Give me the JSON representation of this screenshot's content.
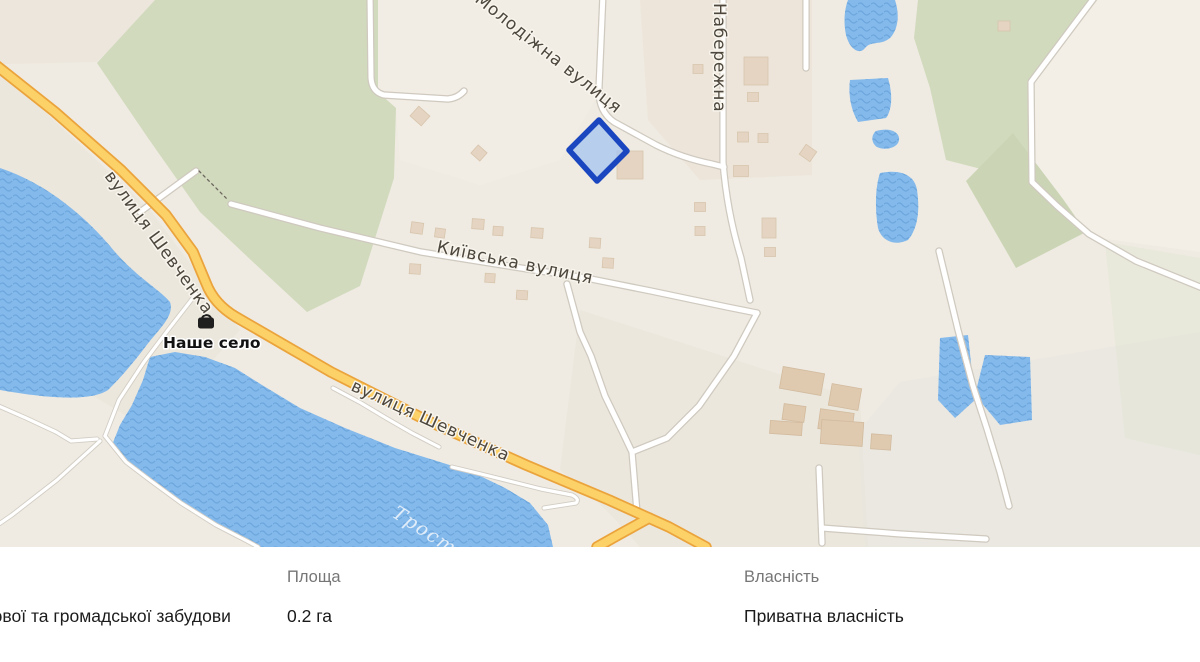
{
  "map": {
    "streets": [
      {
        "id": "molodizhna",
        "text": "Молодіжна вулиця"
      },
      {
        "id": "naberezhna",
        "text": "Набережна"
      },
      {
        "id": "kyivska",
        "text": "Київська вулиця"
      },
      {
        "id": "shevchenka_upper",
        "text": "вулиця Шевченка"
      },
      {
        "id": "shevchenka_lower",
        "text": "вулиця Шевченка"
      }
    ],
    "poi": {
      "label": "Наше село",
      "icon": "shop-basket-icon"
    },
    "river_label": "Трост",
    "parcel": {
      "fill": "#a6c5ef",
      "border": "#1a46c0"
    },
    "palette": {
      "land": "#efebe2",
      "forest": "#d1dabd",
      "water": "#84b9ec",
      "water_wave": "#69a4da",
      "road_primary_fill": "#fbd168",
      "road_primary_casing": "#eba33c",
      "road_fill": "#ffffff",
      "road_casing": "#cfc9bf",
      "building": "#e4d4c1"
    }
  },
  "info_panel": {
    "land_use_fragment": "нової та громадської забудови",
    "fields": [
      {
        "label": "Площа",
        "value": "0.2 га"
      },
      {
        "label": "Власність",
        "value": "Приватна власність"
      }
    ]
  }
}
